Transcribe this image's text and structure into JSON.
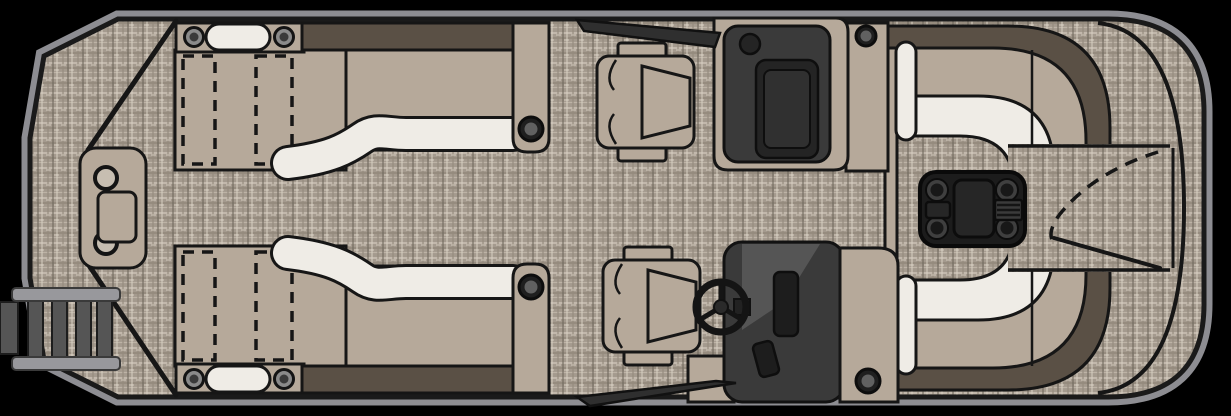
{
  "diagram": {
    "type": "pontoon-boat-floorplan-top-view",
    "orientation": "bow-left-stern-right"
  },
  "colors": {
    "background": "#000000",
    "rubrail": "#8d8d92",
    "hull_line": "#1a1a1a",
    "carpet_base": "#a49a8e",
    "carpet_light": "#cfc6b9",
    "carpet_dark": "#6f675c",
    "seat_tan": "#b6a99a",
    "cushion_white": "#efece6",
    "backrest_brown": "#5a5045",
    "console_dark": "#3a3a3a",
    "panel_darker": "#242424",
    "table_black": "#1c1c1c",
    "ladder_gray": "#98989c",
    "rung_gray": "#555555"
  },
  "components": {
    "bow_gate_console": {
      "cup_holders": 2,
      "tray": 1
    },
    "boarding_ladder": {
      "rungs": 4,
      "side": "port-bow"
    },
    "bow_chaise_lounges": {
      "count": 2,
      "recliner_outlines_each": 2,
      "headrest_speakers_each": 2,
      "pillows_each": 1,
      "arm_cup_holders_each": 1
    },
    "captains_chairs": {
      "count": 2,
      "facing": "stern"
    },
    "port_console": {
      "speaker": 1,
      "windscreen": true
    },
    "helm_console": {
      "steering_wheel": true,
      "windscreen": true,
      "cup_holder": 1,
      "gauges": 2
    },
    "rear_horseshoe_lounge": {
      "benches": 2,
      "white_cushion_bands": 2,
      "arm_pillows": 2
    },
    "rear_table": {
      "cup_holders": 4,
      "center_tray": 1,
      "side_slot": 1,
      "vent_grill": 1
    },
    "stern_gate": {
      "swing_arc": "dashed",
      "gate_open_line": true
    }
  }
}
